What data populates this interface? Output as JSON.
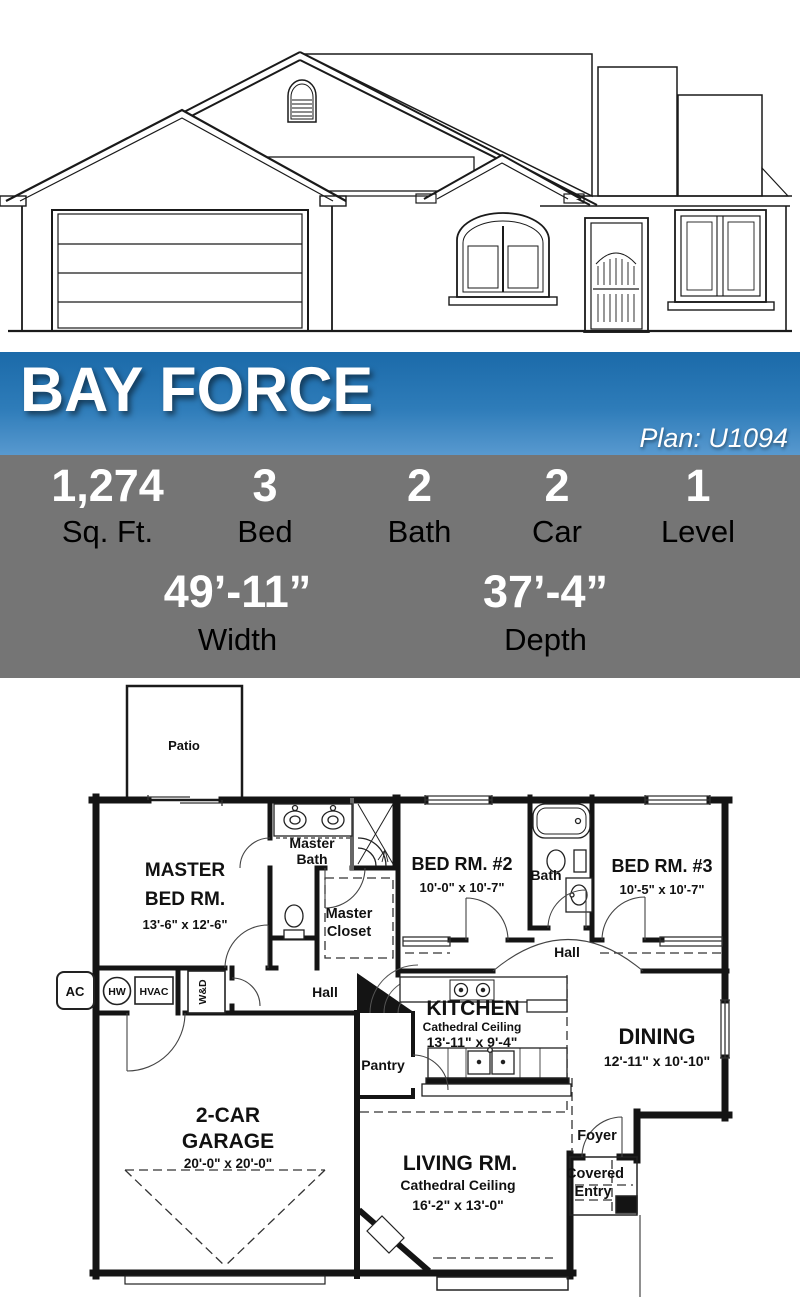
{
  "header": {
    "title": "BAY FORCE",
    "plan_label": "Plan: U1094"
  },
  "stats": {
    "row1": [
      {
        "value": "1,274",
        "label": "Sq. Ft."
      },
      {
        "value": "3",
        "label": "Bed"
      },
      {
        "value": "2",
        "label": "Bath"
      },
      {
        "value": "2",
        "label": "Car"
      },
      {
        "value": "1",
        "label": "Level"
      }
    ],
    "row2": [
      {
        "value": "49’-11”",
        "label": "Width"
      },
      {
        "value": "37’-4”",
        "label": "Depth"
      }
    ]
  },
  "colors": {
    "banner_top": "#1b6aa9",
    "banner_bottom": "#5899cf",
    "stats_bg": "#757575",
    "value_text": "#ffffff",
    "label_text": "#000000",
    "line": "#1a1a1a"
  },
  "floor_plan": {
    "patio": "Patio",
    "master_bed_1": "MASTER",
    "master_bed_2": "BED RM.",
    "master_bed_dim": "13'-6\" x 12'-6\"",
    "master_bath_1": "Master",
    "master_bath_2": "Bath",
    "master_closet_1": "Master",
    "master_closet_2": "Closet",
    "bed2": "BED RM. #2",
    "bed2_dim": "10'-0\" x 10'-7\"",
    "bath": "Bath",
    "bed3": "BED RM. #3",
    "bed3_dim": "10'-5\" x 10'-7\"",
    "hall_center": "Hall",
    "hall_left": "Hall",
    "kitchen": "KITCHEN",
    "kitchen_sub": "Cathedral Ceiling",
    "kitchen_dim": "13'-11\" x 9'-4\"",
    "dining": "DINING",
    "dining_dim": "12'-11\" x 10'-10\"",
    "pantry": "Pantry",
    "garage_1": "2-CAR",
    "garage_2": "GARAGE",
    "garage_dim": "20'-0\" x 20'-0\"",
    "living_1": "LIVING RM.",
    "living_2": "Cathedral Ceiling",
    "living_dim": "16'-2\" x 13'-0\"",
    "foyer": "Foyer",
    "entry_1": "Covered",
    "entry_2": "Entry",
    "ac": "AC",
    "hw": "HW",
    "hvac": "HVAC",
    "wd": "W&D"
  }
}
